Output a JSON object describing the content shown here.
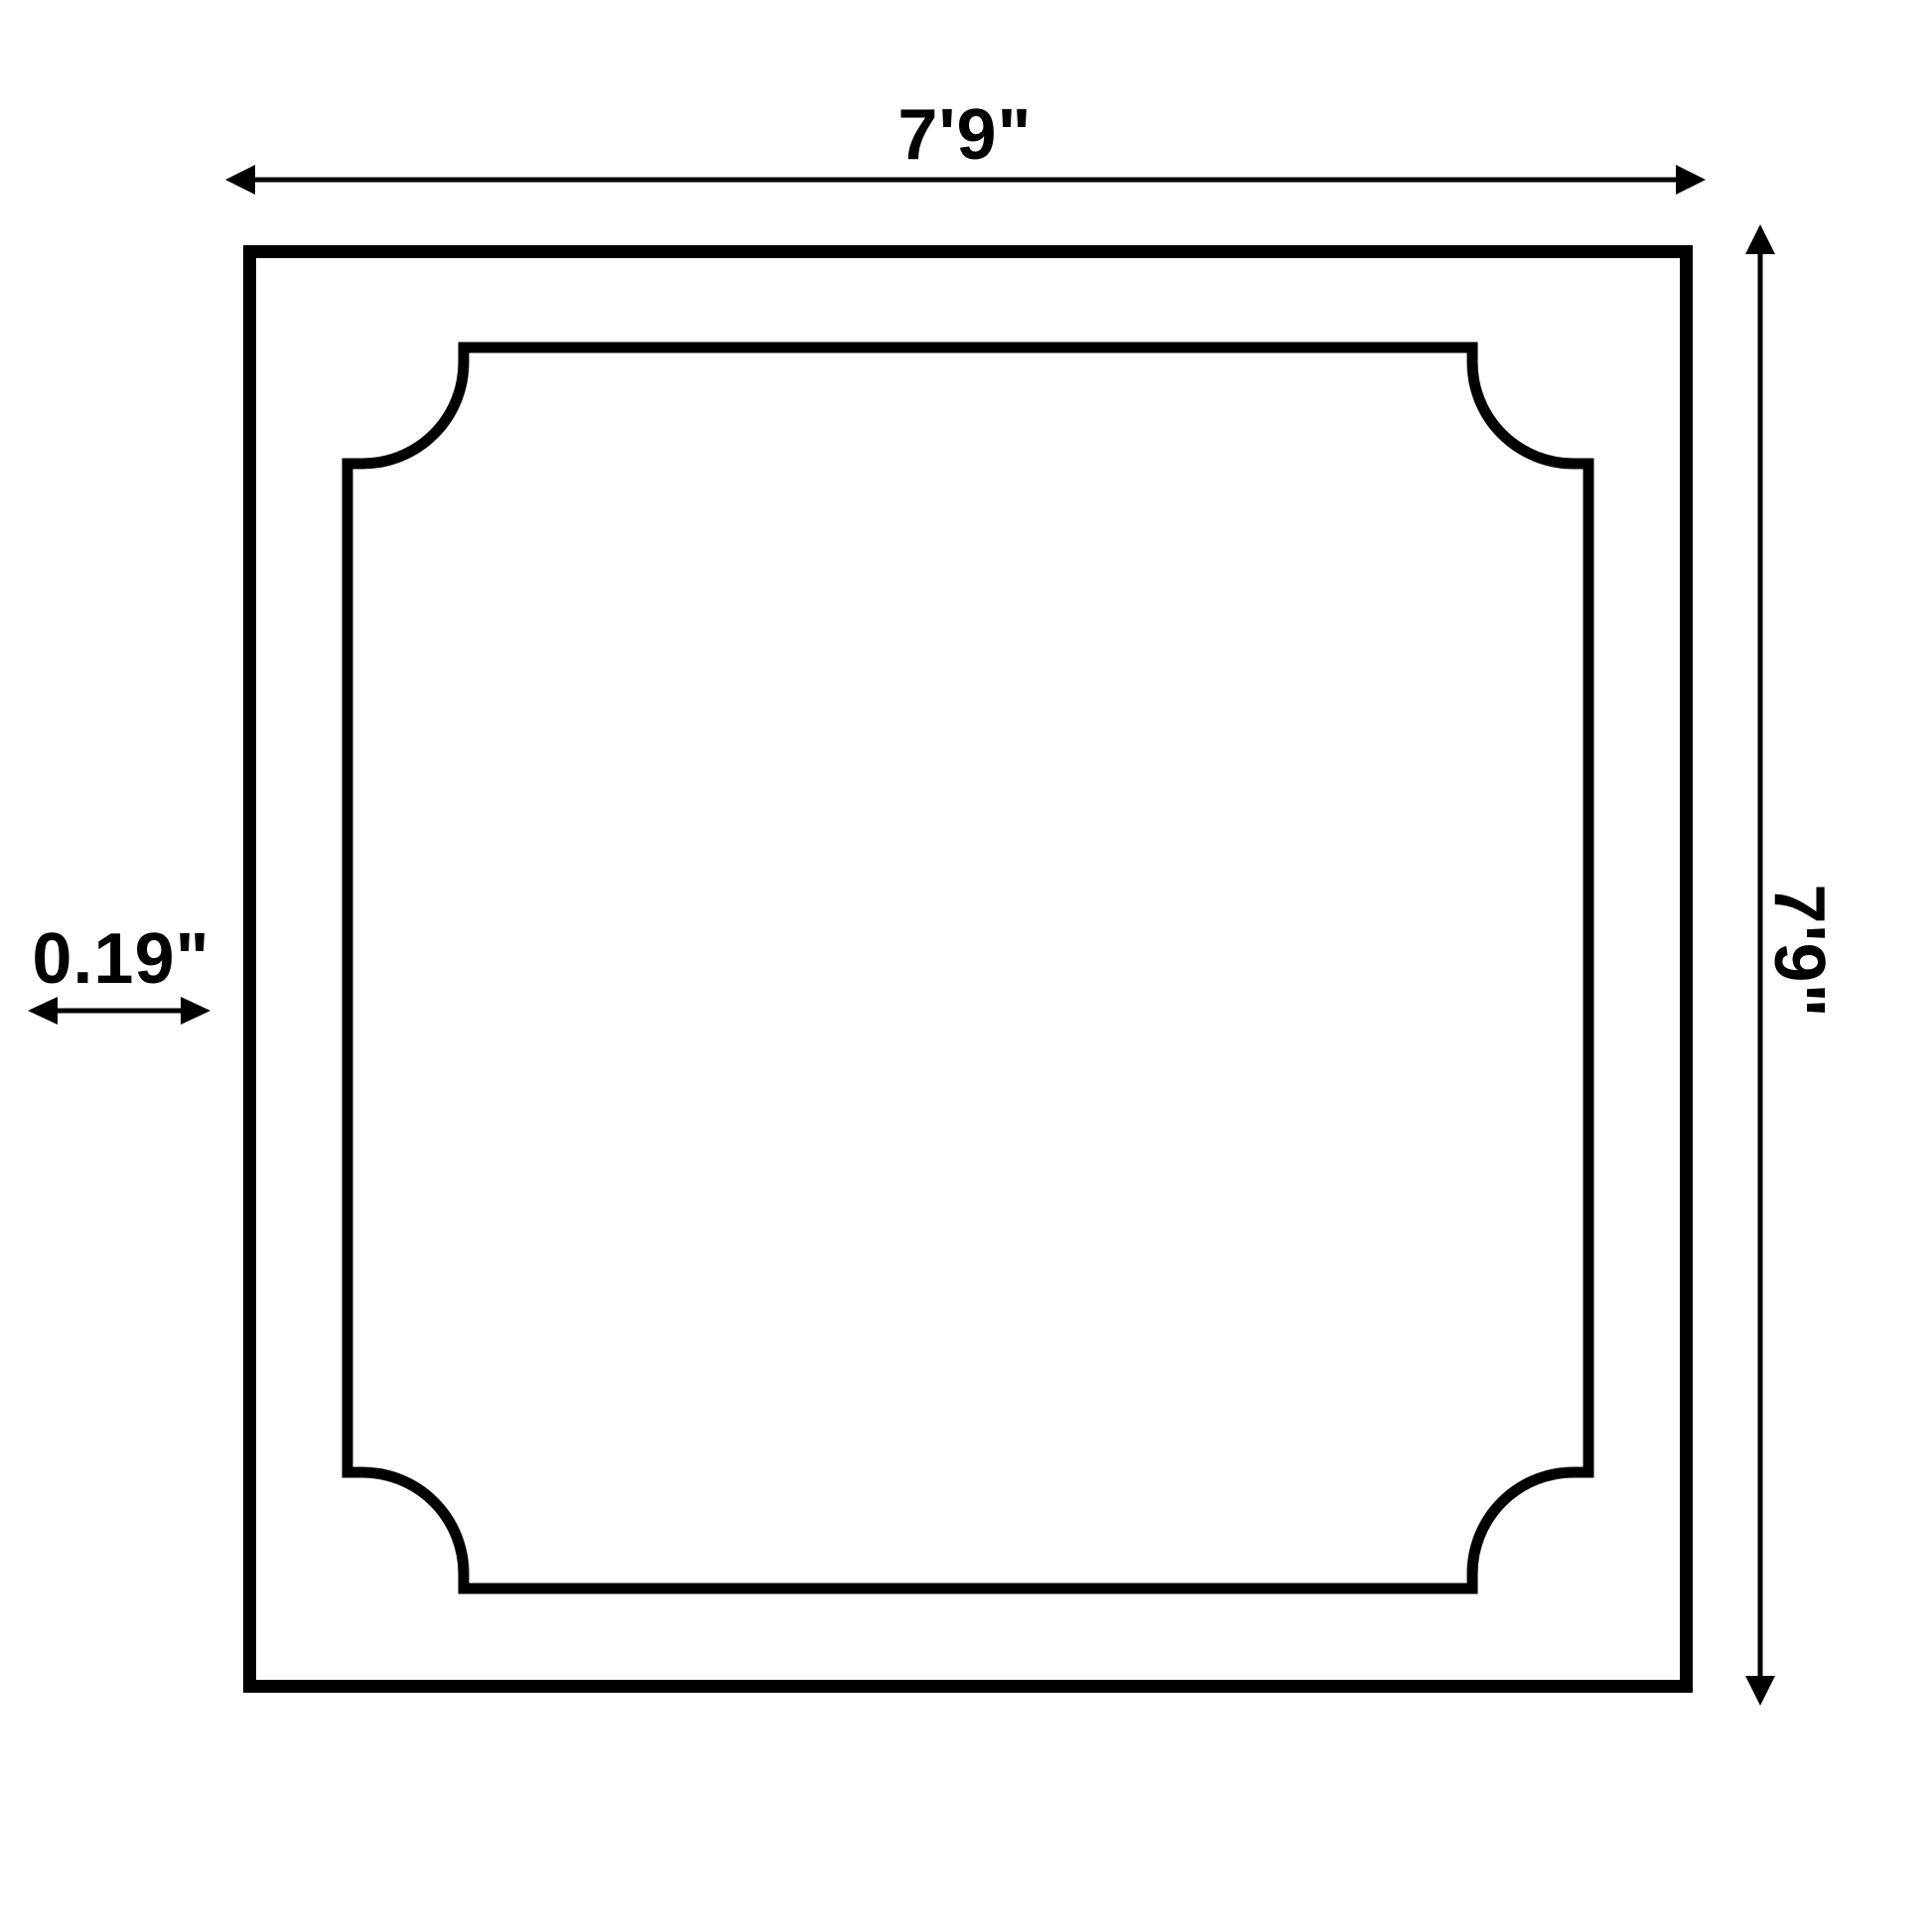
{
  "diagram": {
    "type": "product-dimension-drawing",
    "background_color": "#ffffff",
    "line_color": "#000000",
    "shape_description": "square panel with inner frame border having concave scalloped corners",
    "dimensions": {
      "width_label": "7'9\"",
      "height_label": "7'9\"",
      "thickness_label": "0.19\""
    }
  }
}
